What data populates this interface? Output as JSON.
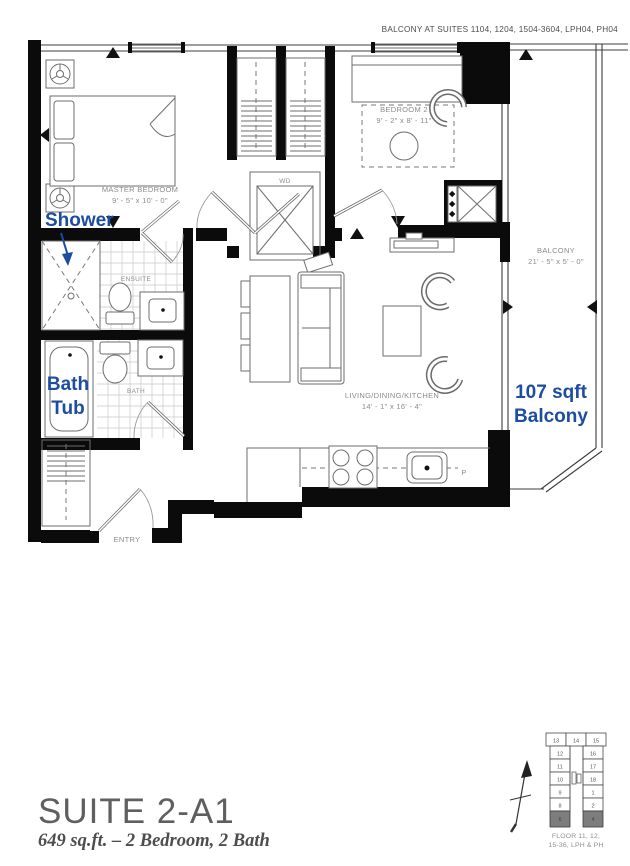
{
  "note": {
    "balcony": "BALCONY AT SUITES 1104, 1204, 1504-3604, LPH04, PH04"
  },
  "rooms": {
    "master_bedroom": {
      "name": "MASTER BEDROOM",
      "dims": "9' - 5\" x 10' - 0\""
    },
    "bedroom_2": {
      "name": "BEDROOM 2",
      "dims": "9' - 2\" x 8' - 11\""
    },
    "living": {
      "name": "LIVING/DINING/KITCHEN",
      "dims": "14' - 1\" x 16' - 4\""
    },
    "balcony": {
      "name": "BALCONY",
      "dims": "21' - 5\" x 5' - 0\""
    },
    "ensuite": {
      "name": "ENSUITE"
    },
    "bath": {
      "name": "BATH"
    },
    "entry": {
      "name": "ENTRY"
    },
    "washer_dryer": {
      "label": "WD"
    },
    "pantry": {
      "label": "P"
    }
  },
  "annotations": {
    "color": "#1d4da0",
    "shower": "Shower",
    "bath_tub": {
      "line1": "Bath",
      "line2": "Tub"
    },
    "balcony_area": {
      "line1": "107 sqft",
      "line2": "Balcony"
    }
  },
  "title": {
    "suite": "SUITE 2-A1",
    "details": "649 sq.ft. – 2 Bedroom, 2 Bath"
  },
  "keyplan": {
    "caption1": "FLOOR 11, 12,",
    "caption2": "15-36, LPH & PH",
    "top_row": [
      "13",
      "14",
      "15"
    ],
    "left_col": [
      "12",
      "11",
      "10",
      "9",
      "8"
    ],
    "right_col": [
      "16",
      "17",
      "18",
      "1",
      "2"
    ],
    "highlighted": [
      "6",
      "4"
    ]
  }
}
